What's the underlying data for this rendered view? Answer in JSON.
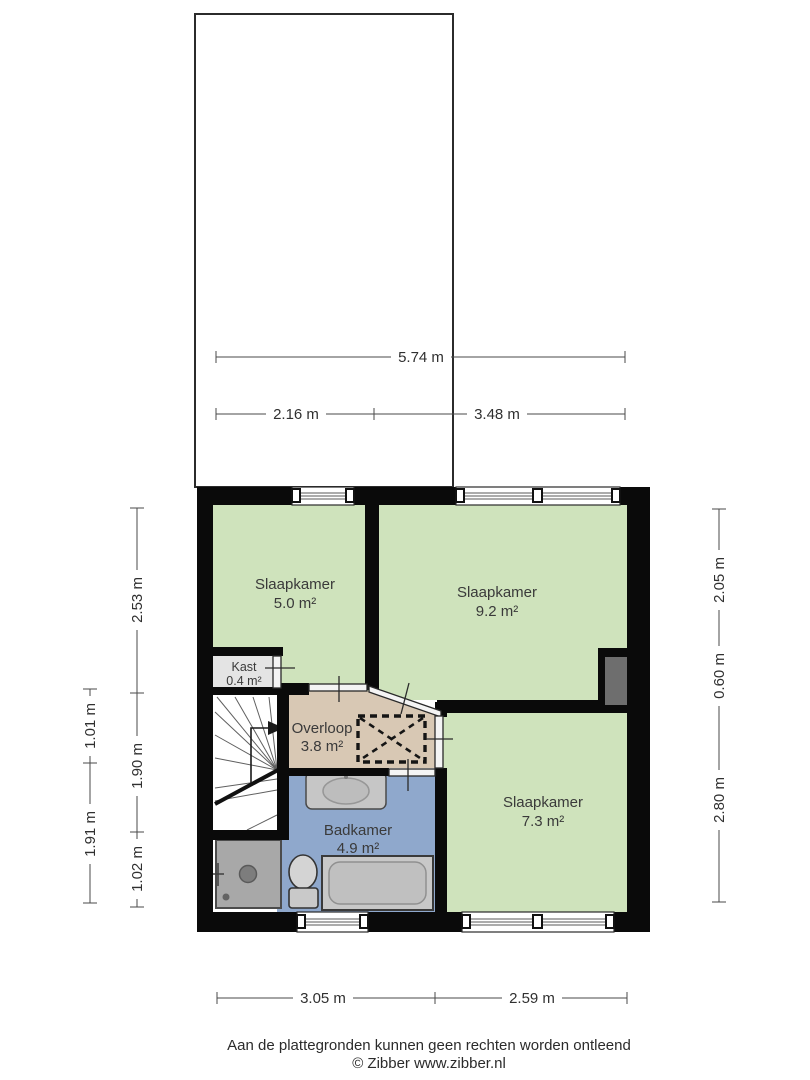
{
  "title": "floor-plan",
  "rooms": [
    {
      "id": "slaapkamer-1",
      "name": "Slaapkamer",
      "area": "5.0 m²"
    },
    {
      "id": "slaapkamer-2",
      "name": "Slaapkamer",
      "area": "9.2 m²"
    },
    {
      "id": "slaapkamer-3",
      "name": "Slaapkamer",
      "area": "7.3 m²"
    },
    {
      "id": "kast",
      "name": "Kast",
      "area": "0.4 m²"
    },
    {
      "id": "overloop",
      "name": "Overloop",
      "area": "3.8 m²"
    },
    {
      "id": "badkamer",
      "name": "Badkamer",
      "area": "4.9 m²"
    }
  ],
  "dimensions": {
    "top_total": "5.74 m",
    "top_left": "2.16 m",
    "top_right": "3.48 m",
    "left_inner": [
      "2.53 m",
      "1.90 m",
      "1.02 m"
    ],
    "left_outer": [
      "1.01 m",
      "1.91 m"
    ],
    "right": [
      "2.05 m",
      "0.60 m",
      "2.80 m"
    ],
    "bottom": [
      "3.05 m",
      "2.59 m"
    ]
  },
  "footer": {
    "disclaimer": "Aan de plattegronden kunnen geen rechten worden ontleend",
    "credit": "© Zibber www.zibber.nl"
  },
  "colors": {
    "room_green": "#cfe3bc",
    "landing_tan": "#d8c8b4",
    "bath_blue": "#8fa8cc",
    "closet_gray": "#e4e4e4",
    "shaft_gray": "#6e6e6e",
    "wall_black": "#0a0a0a",
    "shower_gray": "#a8a8a8",
    "fixture_gray": "#c6c6c6"
  }
}
